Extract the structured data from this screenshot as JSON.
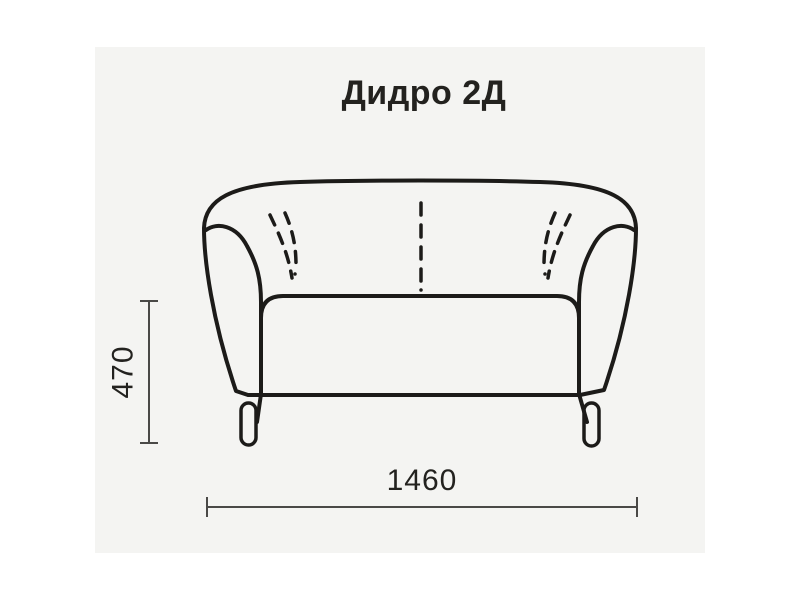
{
  "title": "Дидро 2Д",
  "dimensions": {
    "height": "470",
    "width": "1460"
  },
  "drawing": {
    "subject": "two-seat sofa, front view outline drawing"
  },
  "colors": {
    "page_background": "#ffffff",
    "panel_background": "#f4f4f2",
    "line": "#1c1b19",
    "dimension_line": "#4a4947",
    "text": "#23221f"
  }
}
